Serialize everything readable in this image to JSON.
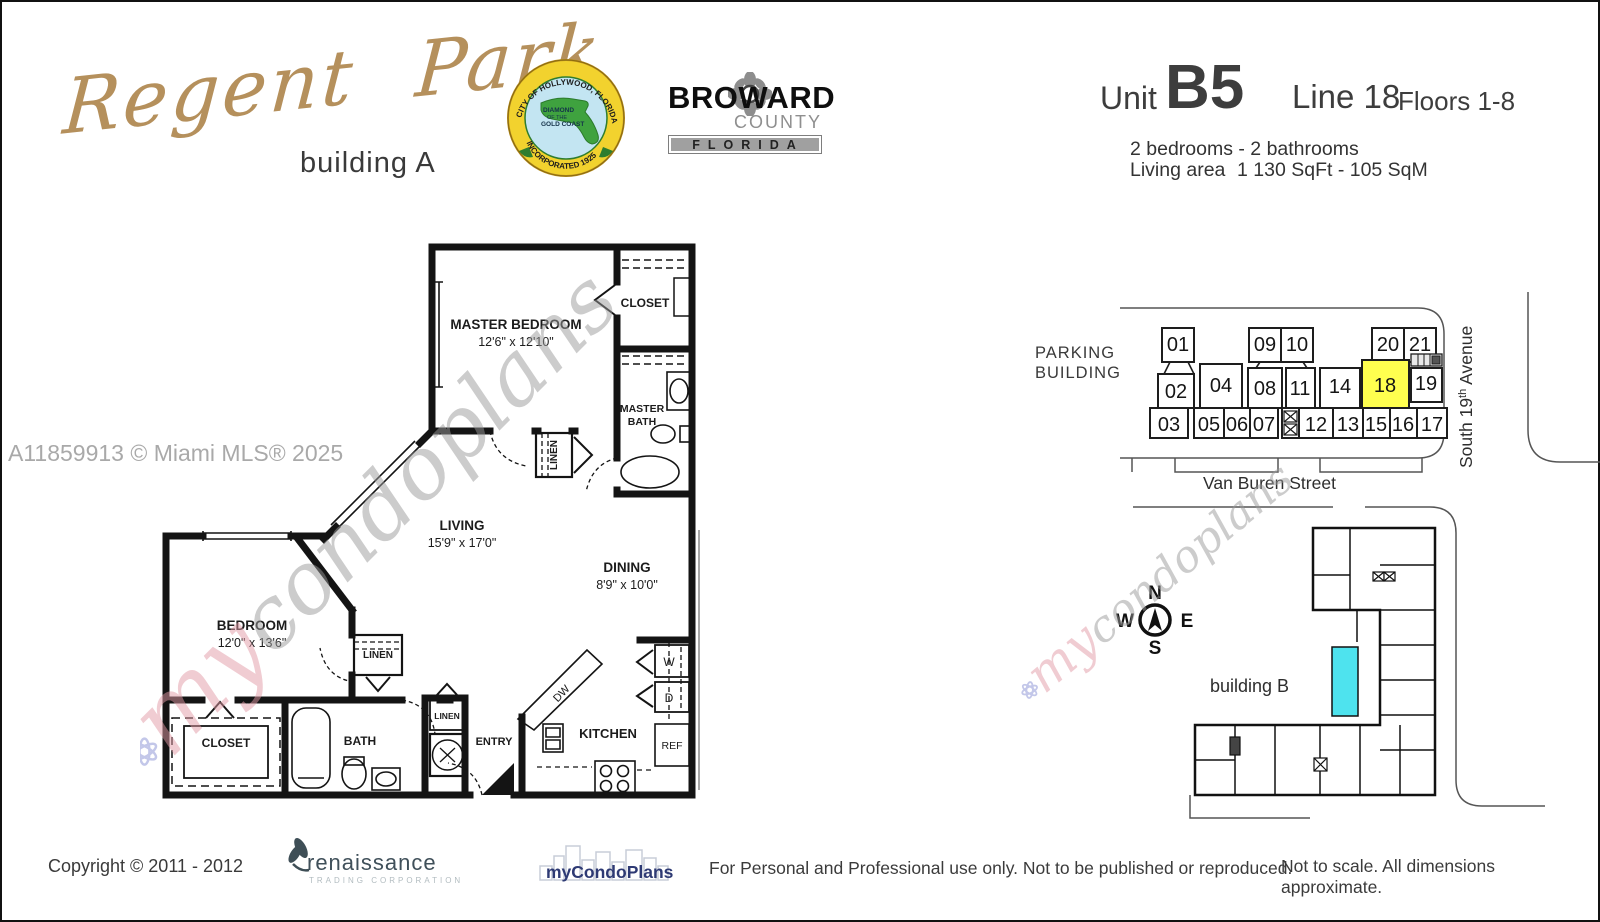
{
  "header": {
    "logo_name": "Regent Park",
    "logo_subtitle": "building A",
    "seal": {
      "arc_top": "CITY OF HOLLYWOOD, FLORIDA",
      "arc_bottom": "INCORPORATED 1925",
      "center_1": "DIAMOND",
      "center_2": "OF THE",
      "center_3": "GOLD COAST"
    },
    "broward": {
      "name": "BROWARD",
      "county": "COUNTY",
      "state": "FLORIDA"
    },
    "unit": {
      "label": "Unit",
      "number": "B5",
      "line": "Line 18",
      "floors": "Floors 1-8",
      "beds": "2 bedrooms - 2 bathrooms",
      "living_label": "Living area",
      "living_value": "1 130 SqFt - 105 SqM"
    }
  },
  "watermarks": {
    "mls": "A11859913 © Miami MLS® 2025",
    "script_my": "my",
    "script_rest": "condoplans"
  },
  "floor_plan": {
    "master_bedroom": {
      "name": "MASTER BEDROOM",
      "dims": "12'6\" x 12'10\""
    },
    "bedroom": {
      "name": "BEDROOM",
      "dims": "12'0\" x 13'6\""
    },
    "living": {
      "name": "LIVING",
      "dims": "15'9\" x 17'0\""
    },
    "dining": {
      "name": "DINING",
      "dims": "8'9\" x 10'0\""
    },
    "kitchen": "KITCHEN",
    "bath": "BATH",
    "master_bath_1": "MASTER",
    "master_bath_2": "BATH",
    "closet_master": "CLOSET",
    "closet_bedroom": "CLOSET",
    "linen_hall": "LINEN",
    "linen_center": "LINEN",
    "linen_entry": "LINEN",
    "entry": "ENTRY",
    "appliances": {
      "dw": "DW",
      "washer": "W",
      "dryer": "D",
      "fridge": "REF"
    }
  },
  "site_plan": {
    "parking_1": "PARKING",
    "parking_2": "BUILDING",
    "van_buren": "Van Buren Street",
    "south_ave_1": "South 19",
    "south_ave_sup": "th",
    "south_ave_2": " Avenue",
    "building_b": "building B",
    "highlight_color": "#ffff4f",
    "pool_color": "#4ee3ee",
    "compass": {
      "n": "N",
      "e": "E",
      "s": "S",
      "w": "W"
    },
    "units": [
      "01",
      "02",
      "03",
      "04",
      "05",
      "06",
      "07",
      "08",
      "09",
      "10",
      "11",
      "12",
      "13",
      "14",
      "15",
      "16",
      "17",
      "18",
      "19",
      "20",
      "21"
    ]
  },
  "footer": {
    "copyright": "Copyright © 2011 - 2012",
    "renaissance_name": "renaissance",
    "renaissance_sub": "TRADING CORPORATION",
    "mycondoplans": "myCondoPlans",
    "usage": "For Personal and Professional use only.  Not to be published or reproduced.",
    "scale_note": "Not to scale.  All dimensions approximate."
  }
}
